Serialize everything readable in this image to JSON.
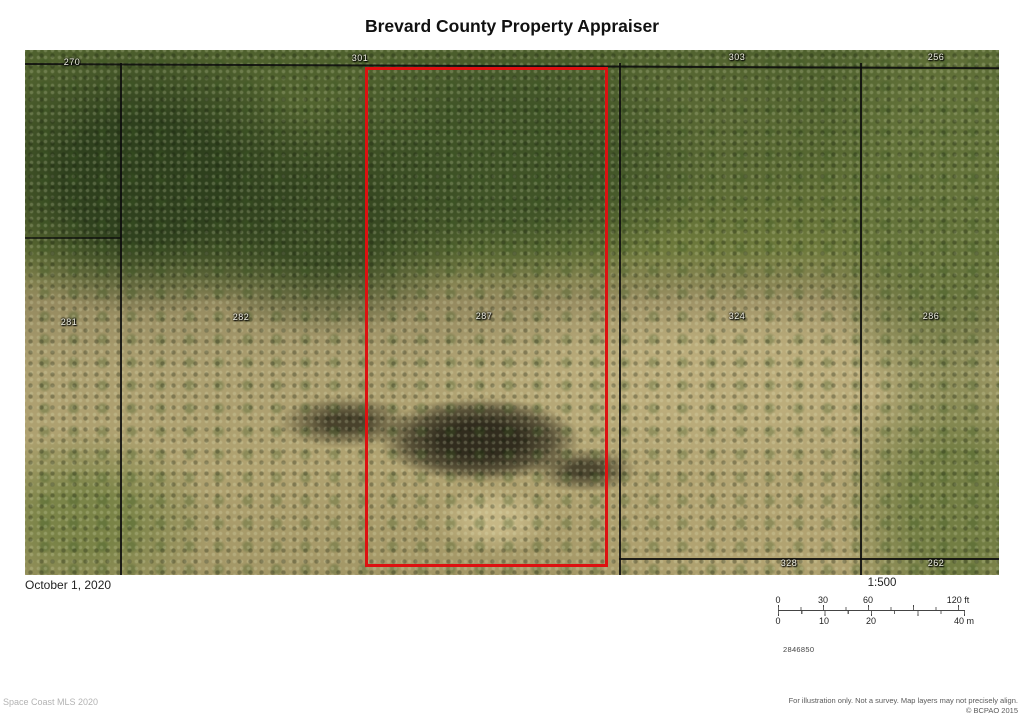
{
  "header": {
    "title": "Brevard County Property Appraiser"
  },
  "map": {
    "parcels": [
      {
        "label": "270"
      },
      {
        "label": "301"
      },
      {
        "label": "303"
      },
      {
        "label": "256"
      },
      {
        "label": "281"
      },
      {
        "label": "282"
      },
      {
        "label": "287"
      },
      {
        "label": "324"
      },
      {
        "label": "286"
      },
      {
        "label": "328"
      },
      {
        "label": "262"
      }
    ],
    "highlighted_parcel": "287",
    "highlight_color": "#dd1111"
  },
  "footer": {
    "date": "October 1, 2020",
    "scale_ratio": "1:500",
    "scalebar": {
      "ft_labels": [
        "0",
        "30",
        "60",
        "120 ft"
      ],
      "m_labels": [
        "0",
        "10",
        "20",
        "40 m"
      ]
    },
    "map_number": "2846850",
    "attribution": "Space Coast MLS 2020",
    "disclaimer_line1": "For illustration only. Not a survey. Map layers may not precisely align.",
    "disclaimer_line2": "© BCPAO 2015"
  }
}
